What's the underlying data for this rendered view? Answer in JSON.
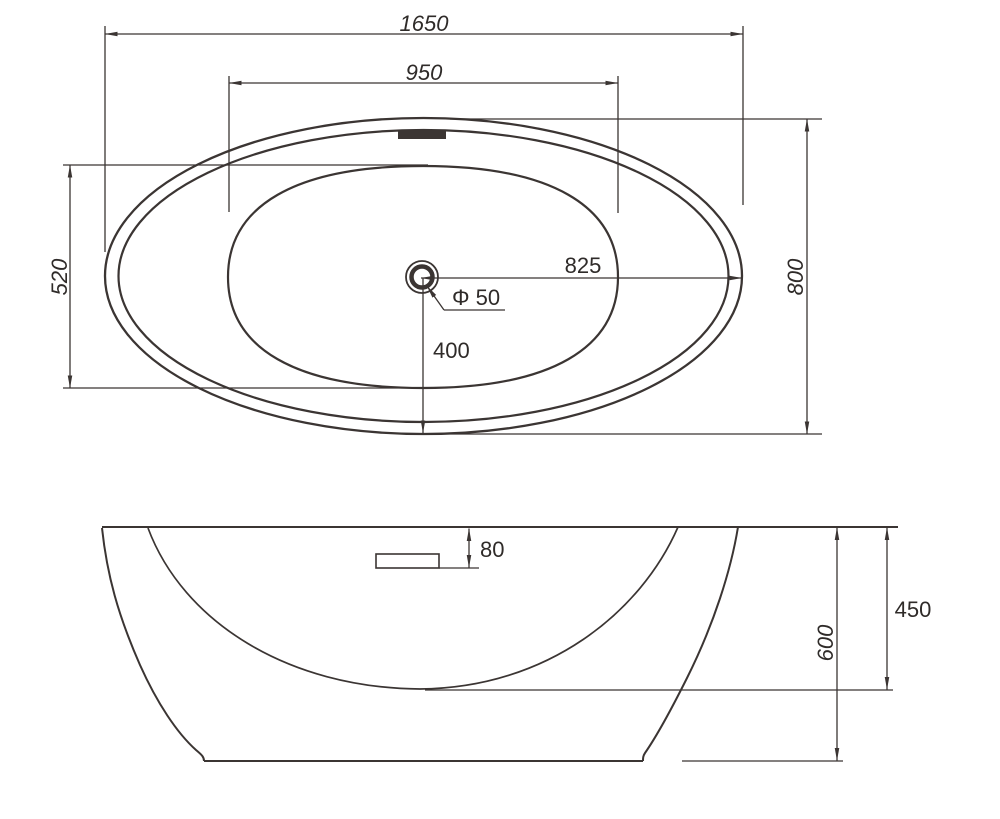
{
  "colors": {
    "line": "#3b3533",
    "text": "#2f2b29",
    "background": "#ffffff"
  },
  "top_view": {
    "overall_length_mm": "1650",
    "basin_length_mm": "950",
    "basin_width_mm": "520",
    "overall_width_mm": "800",
    "drain_to_right_edge_mm": "825",
    "drain_to_bottom_edge_mm": "400",
    "drain_diameter_label": "Φ 50"
  },
  "side_view": {
    "overflow_drop_mm": "80",
    "inner_depth_mm": "450",
    "overall_height_mm": "600"
  }
}
